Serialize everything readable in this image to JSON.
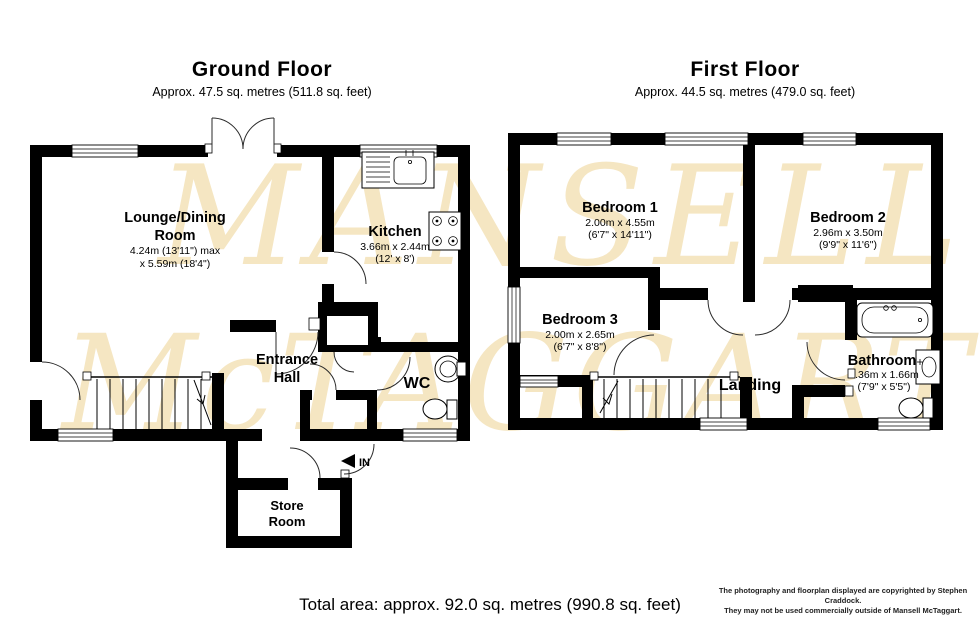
{
  "watermark": {
    "line1": "MANSELL",
    "line2": "McTAGGART",
    "color": "#f5e6c2"
  },
  "ground_floor": {
    "title": "Ground Floor",
    "subtitle": "Approx. 47.5 sq. metres (511.8 sq. feet)",
    "rooms": {
      "lounge": {
        "name1": "Lounge/Dining",
        "name2": "Room",
        "dim1": "4.24m (13'11\") max",
        "dim2": "x 5.59m (18'4\")"
      },
      "kitchen": {
        "name": "Kitchen",
        "dim1": "3.66m x 2.44m",
        "dim2": "(12' x 8')"
      },
      "hall": {
        "name1": "Entrance",
        "name2": "Hall"
      },
      "wc": {
        "name": "WC"
      },
      "store": {
        "name1": "Store",
        "name2": "Room"
      }
    },
    "in_label": "IN"
  },
  "first_floor": {
    "title": "First Floor",
    "subtitle": "Approx. 44.5 sq. metres (479.0 sq. feet)",
    "rooms": {
      "bedroom1": {
        "name": "Bedroom 1",
        "dim1": "2.00m x 4.55m",
        "dim2": "(6'7\" x 14'11\")"
      },
      "bedroom2": {
        "name": "Bedroom 2",
        "dim1": "2.96m x 3.50m",
        "dim2": "(9'9\" x 11'6\")"
      },
      "bedroom3": {
        "name": "Bedroom 3",
        "dim1": "2.00m x 2.65m",
        "dim2": "(6'7\" x 8'8\")"
      },
      "landing": {
        "name": "Landing"
      },
      "bathroom": {
        "name": "Bathroom",
        "dim1": "2.36m x 1.66m",
        "dim2": "(7'9\" x 5'5\")"
      }
    }
  },
  "footer": {
    "total_area": "Total area: approx. 92.0 sq. metres (990.8 sq. feet)",
    "copyright1": "The photography and floorplan displayed are copyrighted by Stephen Craddock.",
    "copyright2": "They may not be used commercially outside of Mansell McTaggart."
  }
}
